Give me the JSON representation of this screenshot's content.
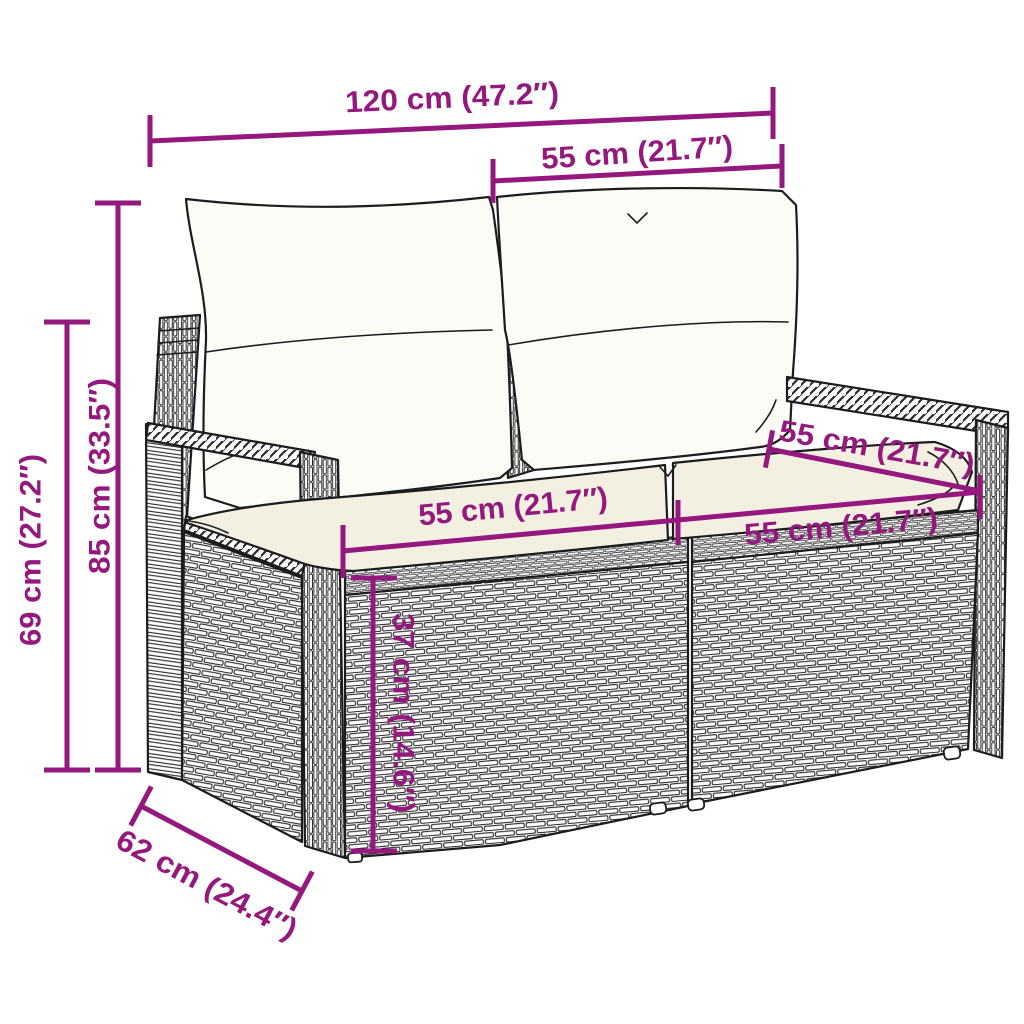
{
  "diagram": {
    "type": "product-dimension-diagram",
    "subject": "poly rattan 2-seater garden sofa (loveseat) with back and seat cushions",
    "view": "three-quarter perspective line sketch with woven texture",
    "colors": {
      "accent": "#94187D",
      "sketch": "#1c1c1c",
      "background": "#FFFFFF",
      "cushion": "#F4F0E1"
    },
    "dimensions": {
      "total_width": "120 cm (47.2″)",
      "back_cushion_width": "55 cm (21.7″)",
      "total_height": "85 cm (33.5″)",
      "armrest_height": "69 cm (27.2″)",
      "seat_depth": "55 cm (21.7″)",
      "seat_width_left": "55 cm (21.7″)",
      "seat_width_right": "55 cm (21.7″)",
      "base_height": "37 cm (14.6″)",
      "total_depth": "62 cm (24.4″)"
    }
  }
}
